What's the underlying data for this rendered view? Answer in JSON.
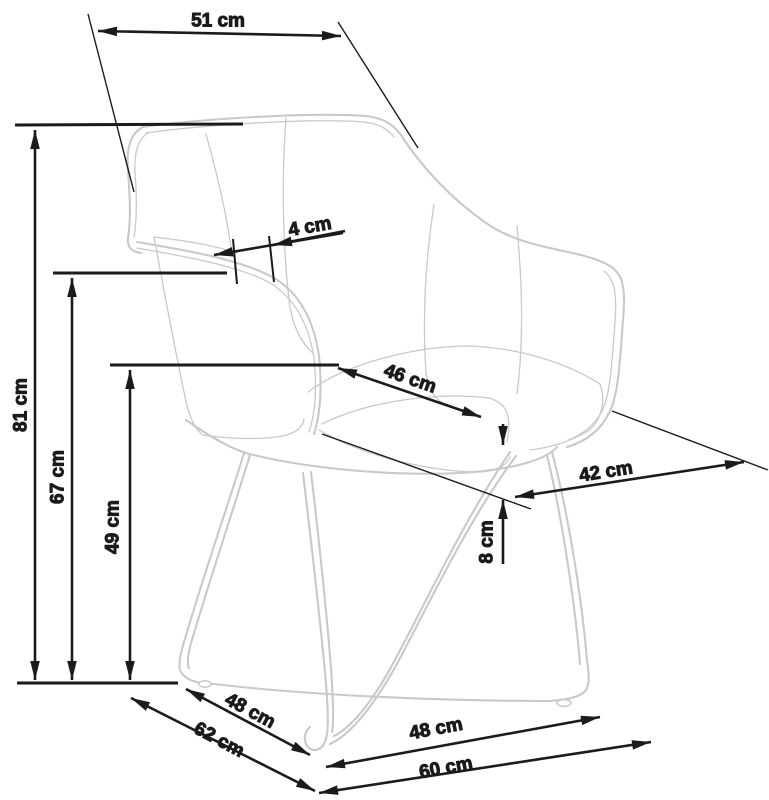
{
  "labels": {
    "back_width": "51 cm",
    "armrest_gap": "4 cm",
    "seat_depth": "46 cm",
    "seat_front_width": "42 cm",
    "total_height": "81 cm",
    "armrest_height": "67 cm",
    "seat_height": "49 cm",
    "cushion_thickness": "8 cm",
    "base_inner_depth": "48 cm",
    "base_depth": "62 cm",
    "base_inner_width": "48 cm",
    "base_width": "60 cm"
  },
  "colors": {
    "dimension": "#1b1b1b",
    "chair": "#c7c9ca",
    "background": "#ffffff"
  }
}
